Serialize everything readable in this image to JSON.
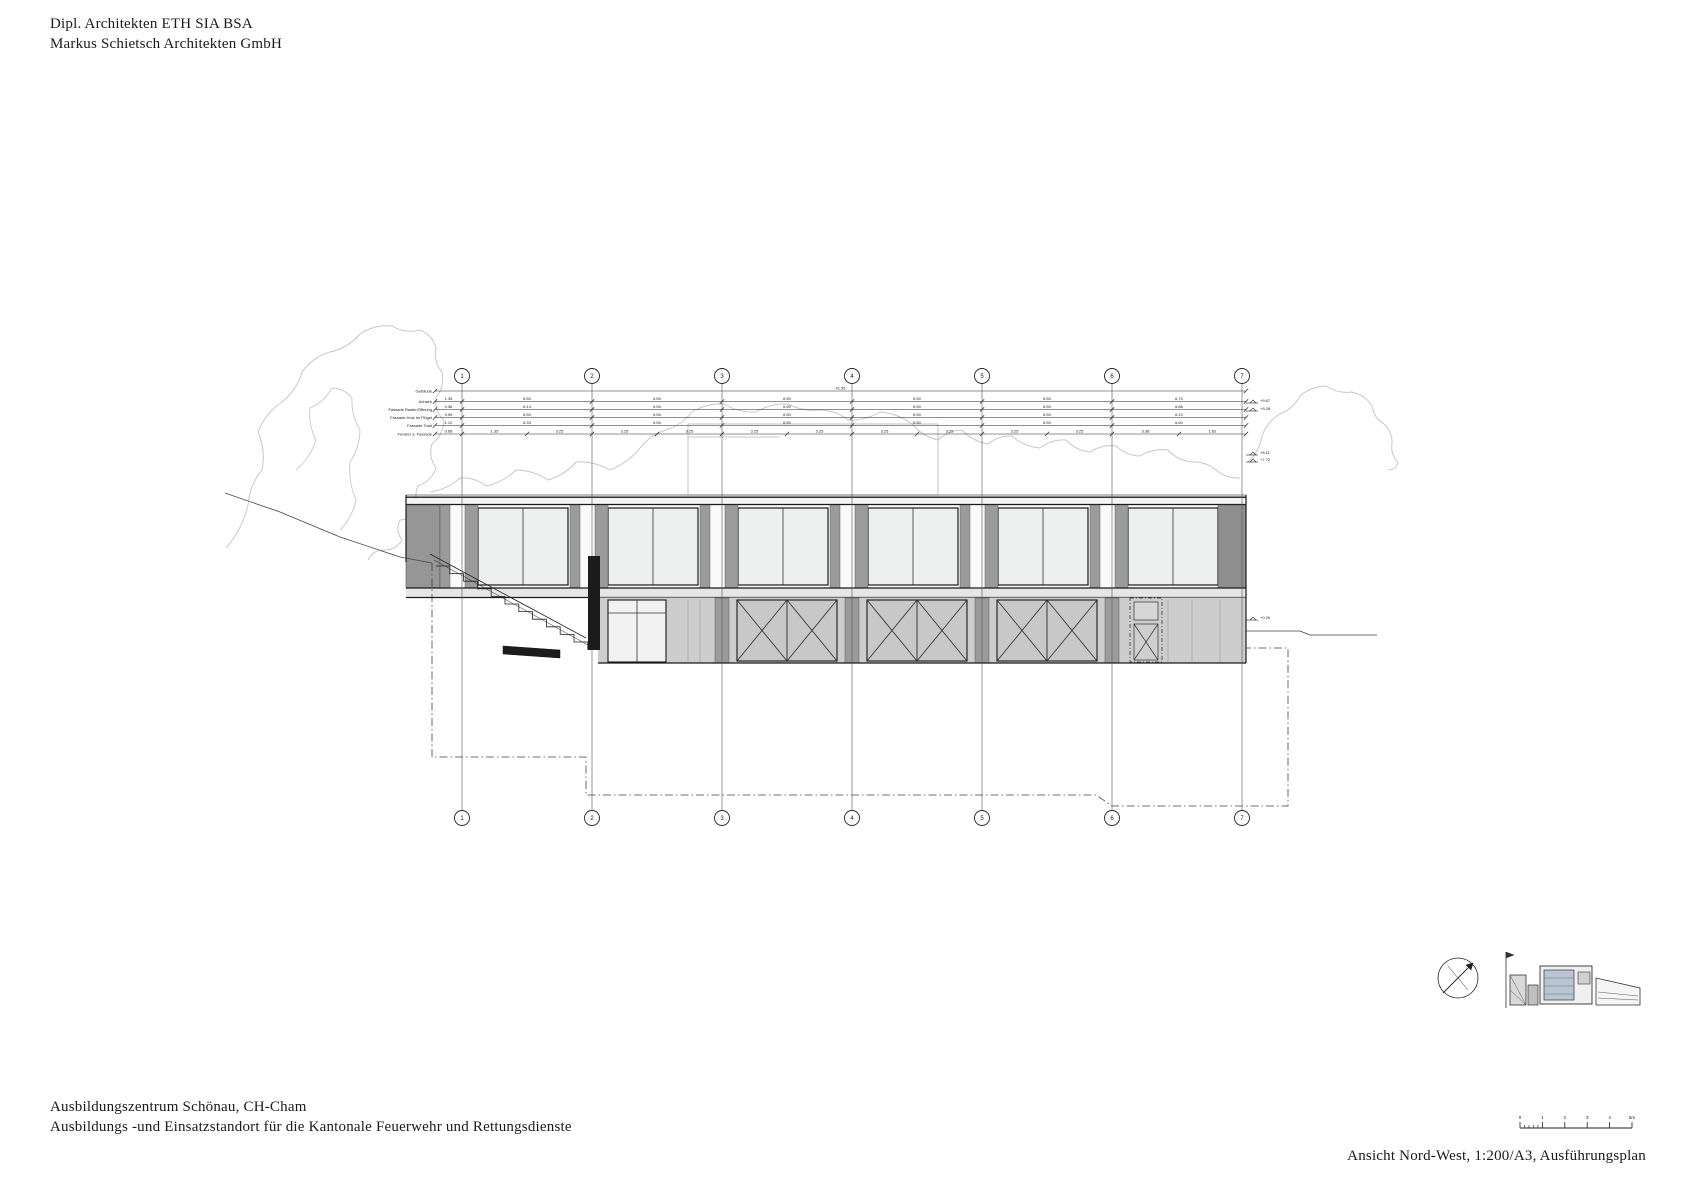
{
  "header": {
    "line1": "Dipl. Architekten ETH SIA BSA",
    "line2": "Markus Schietsch Architekten GmbH"
  },
  "project": {
    "line1": "Ausbildungszentrum Schönau, CH-Cham",
    "line2": "Ausbildungs -und Einsatzstandort für die Kantonale Feuerwehr und Rettungsdienste"
  },
  "caption": "Ansicht Nord-West, 1:200/A3, Ausführungsplan",
  "drawing": {
    "grid": {
      "labels": [
        "1",
        "2",
        "3",
        "4",
        "5",
        "6",
        "7"
      ],
      "x": [
        462,
        592,
        722,
        852,
        982,
        1112,
        1242
      ],
      "top_circle_y": 376,
      "bottom_circle_y": 818
    },
    "dimension_rows": [
      {
        "label": "Gebäude",
        "y": 391,
        "bounds": "full",
        "values": [
          "41.55"
        ]
      },
      {
        "label": "Achsen",
        "y": 401.5,
        "bounds": "grid",
        "values": [
          "1.35",
          "6.50",
          "6.50",
          "6.50",
          "6.50",
          "6.50",
          "6.70"
        ]
      },
      {
        "label": "Fassade Raster/Öffnung",
        "y": 409.5,
        "bounds": "grid",
        "values": [
          "0.36",
          "6.14",
          "6.50",
          "6.50",
          "6.50",
          "6.50",
          "6.86"
        ]
      },
      {
        "label": "Fassade Holz im Flügel",
        "y": 417.5,
        "bounds": "grid",
        "values": [
          "0.95",
          "6.50",
          "6.50",
          "6.50",
          "6.50",
          "6.50",
          "6.10"
        ]
      },
      {
        "label": "Fassade Total",
        "y": 425.5,
        "bounds": "grid",
        "values": [
          "1.12",
          "6.33",
          "6.50",
          "6.50",
          "6.50",
          "6.50",
          "6.60"
        ]
      },
      {
        "label": "Fenster a. Fassade",
        "y": 434,
        "bounds": "half",
        "values": [
          "0.68",
          "1.35",
          "3.25",
          "3.25",
          "3.25",
          "3.25",
          "3.25",
          "3.25",
          "3.25",
          "3.25",
          "3.25",
          "3.38",
          "1.62"
        ]
      }
    ],
    "elevation_markers": [
      {
        "y": 403,
        "text": "+9.67"
      },
      {
        "y": 411,
        "text": "+9.28"
      },
      {
        "y": 455,
        "text": "+8.11"
      },
      {
        "y": 462,
        "text": "+7.72"
      },
      {
        "y": 620,
        "text": "+0.26"
      }
    ],
    "scale_bar": {
      "labels": [
        "0",
        "1",
        "2",
        "3",
        "4",
        "5m"
      ]
    },
    "colors": {
      "line": "#1a1a1a",
      "window": "#eef0ef",
      "door_gray": "#c8c8c8",
      "band_gray": "#9b9b9b",
      "pier_gray": "#969696",
      "slab_gray": "#e6e6e6",
      "infill_gray": "#cdcdcd",
      "terrain": "#c8c8c8",
      "wall_dark": "#1c1c1c",
      "site_accent": "#b9c6d2"
    }
  }
}
